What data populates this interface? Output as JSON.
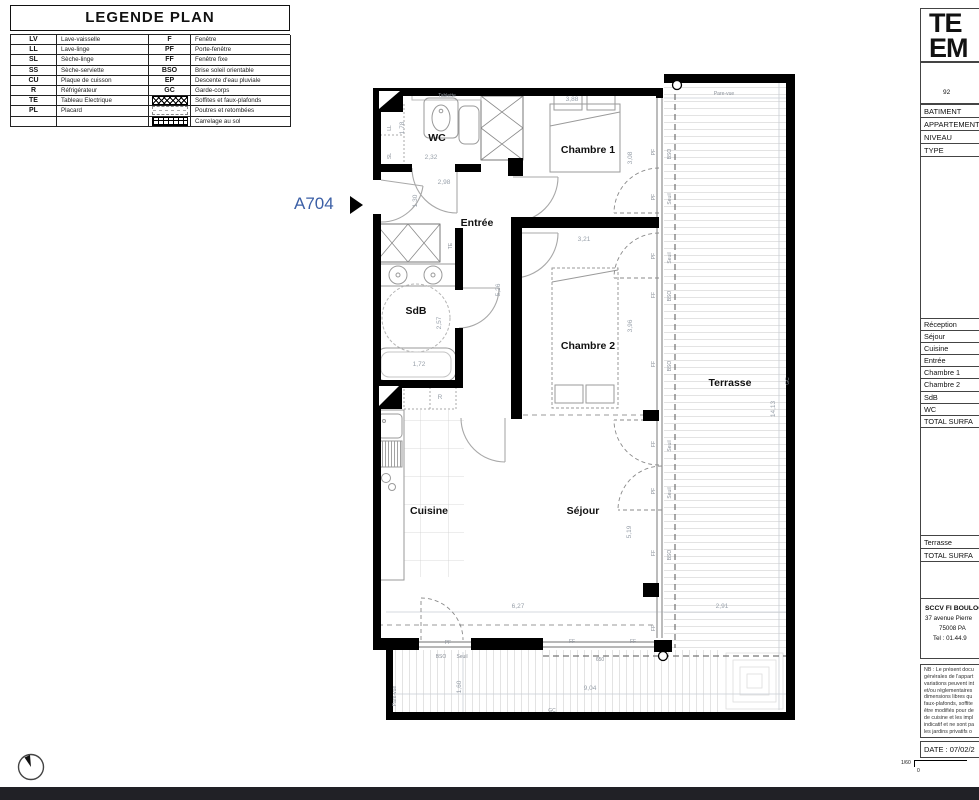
{
  "legend": {
    "title": "LEGENDE PLAN",
    "rows": [
      {
        "a1": "LV",
        "d1": "Lave-vaisselle",
        "a2": "F",
        "d2": "Fenêtre"
      },
      {
        "a1": "LL",
        "d1": "Lave-linge",
        "a2": "PF",
        "d2": "Porte-fenêtre"
      },
      {
        "a1": "SL",
        "d1": "Sèche-linge",
        "a2": "FF",
        "d2": "Fenêtre fixe"
      },
      {
        "a1": "SS",
        "d1": "Sèche-serviette",
        "a2": "BSO",
        "d2": "Brise soleil orientable"
      },
      {
        "a1": "CU",
        "d1": "Plaque de cuisson",
        "a2": "EP",
        "d2": "Descente d'eau pluviale"
      },
      {
        "a1": "R",
        "d1": "Réfrigérateur",
        "a2": "GC",
        "d2": "Garde-corps"
      },
      {
        "a1": "TE",
        "d1": "Tableau Electrique",
        "icon": "hatch",
        "d2": "Soffites et faux-plafonds"
      },
      {
        "a1": "PL",
        "d1": "Placard",
        "icon": "dashes",
        "d2": "Poutres et retombées"
      },
      {
        "a1": "",
        "d1": "",
        "icon": "grid",
        "d2": "Carrelage au sol"
      }
    ]
  },
  "plan": {
    "apartment_id": "A704",
    "texts": [
      {
        "n": "room-wc",
        "x": 437,
        "y": 141,
        "t": "WC",
        "c": "room"
      },
      {
        "n": "room-chambre1",
        "x": 588,
        "y": 153,
        "t": "Chambre 1",
        "c": "room"
      },
      {
        "n": "room-entree",
        "x": 477,
        "y": 226,
        "t": "Entrée",
        "c": "room"
      },
      {
        "n": "room-sdb",
        "x": 416,
        "y": 314,
        "t": "SdB",
        "c": "room"
      },
      {
        "n": "room-chambre2",
        "x": 588,
        "y": 349,
        "t": "Chambre 2",
        "c": "room"
      },
      {
        "n": "room-cuisine",
        "x": 429,
        "y": 514,
        "t": "Cuisine",
        "c": "room"
      },
      {
        "n": "room-sejour",
        "x": 583,
        "y": 514,
        "t": "Séjour",
        "c": "room"
      },
      {
        "n": "room-terrasse",
        "x": 730,
        "y": 386,
        "t": "Terrasse",
        "c": "room"
      },
      {
        "n": "dim",
        "x": 572,
        "y": 101,
        "t": "3,88",
        "c": "dim"
      },
      {
        "n": "dim",
        "x": 632,
        "y": 158,
        "t": "3,08",
        "c": "dim",
        "r": 1
      },
      {
        "n": "dim",
        "x": 431,
        "y": 159,
        "t": "2,32",
        "c": "dim"
      },
      {
        "n": "dim",
        "x": 404,
        "y": 128,
        "t": "1,78",
        "c": "dim",
        "r": 1
      },
      {
        "n": "dim",
        "x": 444,
        "y": 184,
        "t": "2,98",
        "c": "dim"
      },
      {
        "n": "dim",
        "x": 417,
        "y": 201,
        "t": "1,30",
        "c": "dim",
        "r": 1
      },
      {
        "n": "dim",
        "x": 584,
        "y": 241,
        "t": "3,21",
        "c": "dim"
      },
      {
        "n": "dim",
        "x": 500,
        "y": 290,
        "t": "5,26",
        "c": "dim",
        "r": 1
      },
      {
        "n": "dim",
        "x": 441,
        "y": 323,
        "t": "2,57",
        "c": "dim",
        "r": 1
      },
      {
        "n": "dim",
        "x": 419,
        "y": 366,
        "t": "1,72",
        "c": "dim"
      },
      {
        "n": "dim",
        "x": 632,
        "y": 326,
        "t": "3,96",
        "c": "dim",
        "r": 1
      },
      {
        "n": "dim",
        "x": 631,
        "y": 532,
        "t": "5,19",
        "c": "dim",
        "r": 1
      },
      {
        "n": "dim",
        "x": 518,
        "y": 608,
        "t": "6,27",
        "c": "dim"
      },
      {
        "n": "dim",
        "x": 722,
        "y": 608,
        "t": "2,91",
        "c": "dim"
      },
      {
        "n": "dim",
        "x": 775,
        "y": 409,
        "t": "14,13",
        "c": "dim",
        "r": 1
      },
      {
        "n": "dim",
        "x": 461,
        "y": 687,
        "t": "1,60",
        "c": "dim",
        "r": 1
      },
      {
        "n": "dim",
        "x": 590,
        "y": 690,
        "t": "9,04",
        "c": "dim"
      },
      {
        "n": "dim",
        "x": 600,
        "y": 661,
        "t": "650",
        "c": "tiny"
      },
      {
        "n": "label-tablette",
        "x": 447,
        "y": 97,
        "t": "Tablette",
        "c": "tiny"
      },
      {
        "n": "label-ll",
        "x": 391,
        "y": 128,
        "t": "LL",
        "c": "tiny",
        "r": 1
      },
      {
        "n": "label-sl",
        "x": 391,
        "y": 156,
        "t": "SL",
        "c": "tiny",
        "r": 1
      },
      {
        "n": "label-te",
        "x": 452,
        "y": 246,
        "t": "TE",
        "c": "tiny",
        "r": 1
      },
      {
        "n": "label-r",
        "x": 440,
        "y": 399,
        "t": "R",
        "c": "dim"
      },
      {
        "n": "label-pare-vue",
        "x": 724,
        "y": 95,
        "t": "Pare-vue",
        "c": "tiny"
      },
      {
        "n": "label-pare-vue",
        "x": 396,
        "y": 696,
        "t": "Pare-vue",
        "c": "tiny",
        "r": 1
      },
      {
        "n": "label-gc",
        "x": 789,
        "y": 381,
        "t": "GC",
        "c": "tiny",
        "r": 1
      },
      {
        "n": "label-gc",
        "x": 552,
        "y": 712,
        "t": "GC",
        "c": "tiny"
      },
      {
        "n": "label-pf",
        "x": 448,
        "y": 644,
        "t": "PF",
        "c": "tiny"
      },
      {
        "n": "label-ff",
        "x": 572,
        "y": 643,
        "t": "FF",
        "c": "tiny"
      },
      {
        "n": "label-ff",
        "x": 633,
        "y": 643,
        "t": "FF",
        "c": "tiny"
      },
      {
        "n": "label-bso",
        "x": 441,
        "y": 658,
        "t": "BSO",
        "c": "tiny"
      },
      {
        "n": "label-seuil",
        "x": 462,
        "y": 658,
        "t": "Seuil",
        "c": "tiny"
      },
      {
        "n": "label-pf",
        "x": 655,
        "y": 152,
        "t": "PF",
        "c": "tiny",
        "r": 1
      },
      {
        "n": "label-pf",
        "x": 655,
        "y": 197,
        "t": "PF",
        "c": "tiny",
        "r": 1
      },
      {
        "n": "label-pf",
        "x": 655,
        "y": 256,
        "t": "PF",
        "c": "tiny",
        "r": 1
      },
      {
        "n": "label-ff",
        "x": 655,
        "y": 295,
        "t": "FF",
        "c": "tiny",
        "r": 1
      },
      {
        "n": "label-ff",
        "x": 655,
        "y": 364,
        "t": "FF",
        "c": "tiny",
        "r": 1
      },
      {
        "n": "label-ff",
        "x": 655,
        "y": 444,
        "t": "FF",
        "c": "tiny",
        "r": 1
      },
      {
        "n": "label-pf",
        "x": 655,
        "y": 491,
        "t": "PF",
        "c": "tiny",
        "r": 1
      },
      {
        "n": "label-ff",
        "x": 655,
        "y": 553,
        "t": "FF",
        "c": "tiny",
        "r": 1
      },
      {
        "n": "label-ff",
        "x": 655,
        "y": 628,
        "t": "FF",
        "c": "tiny",
        "r": 1
      },
      {
        "n": "label-bso",
        "x": 671,
        "y": 154,
        "t": "BSO",
        "c": "tiny",
        "r": 1
      },
      {
        "n": "label-seuil",
        "x": 671,
        "y": 199,
        "t": "Seuil",
        "c": "tiny",
        "r": 1
      },
      {
        "n": "label-seuil",
        "x": 671,
        "y": 258,
        "t": "Seuil",
        "c": "tiny",
        "r": 1
      },
      {
        "n": "label-bso",
        "x": 671,
        "y": 296,
        "t": "BSO",
        "c": "tiny",
        "r": 1
      },
      {
        "n": "label-bso",
        "x": 671,
        "y": 366,
        "t": "BSO",
        "c": "tiny",
        "r": 1
      },
      {
        "n": "label-seuil",
        "x": 671,
        "y": 446,
        "t": "Seuil",
        "c": "tiny",
        "r": 1
      },
      {
        "n": "label-seuil",
        "x": 671,
        "y": 493,
        "t": "Seuil",
        "c": "tiny",
        "r": 1
      },
      {
        "n": "label-bso",
        "x": 671,
        "y": 555,
        "t": "BSO",
        "c": "tiny",
        "r": 1
      }
    ]
  },
  "panel": {
    "title_line1": "TE",
    "title_line2": "EM",
    "postal": "92",
    "info_rows": [
      "BATIMENT",
      "APPARTEMENT",
      "NIVEAU",
      "TYPE"
    ],
    "room_rows": [
      "Réception",
      "Séjour",
      "Cuisine",
      "Entrée",
      "Chambre 1",
      "Chambre 2",
      "SdB",
      "WC",
      "TOTAL SURFA"
    ],
    "terrace_rows": [
      "Terrasse",
      "TOTAL SURFA"
    ],
    "company": "SCCV FI BOULOG",
    "addr1": "37 avenue Pierre",
    "addr2": "75008 PA",
    "addr3": "Tel : 01.44.9",
    "nb_lines": [
      "NB : Le présent docu",
      "générales de l'appart",
      "variations peuvent int",
      "et/ou réglementaires",
      "dimensions libres qu",
      "faux-plafonds, soffite",
      "être modifiés pour de",
      "de cuisine et les impl",
      "indicatif et ne sont pa",
      "les jardins privatifs o"
    ],
    "date": "DATE : 07/02/2"
  },
  "scale": {
    "ratio": "1/60",
    "zero": "0"
  }
}
